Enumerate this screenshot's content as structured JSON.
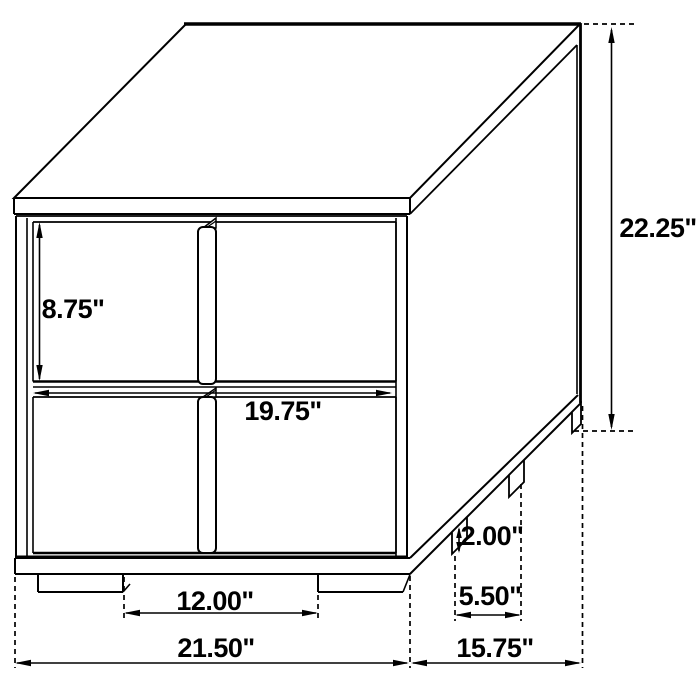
{
  "diagram": {
    "subject": "two-drawer-nightstand-dimension-drawing",
    "unit": "inches",
    "line_color": "#000000",
    "background_color": "#ffffff",
    "dimensions": [
      {
        "id": "top-drawer-height",
        "label": "8.75\""
      },
      {
        "id": "drawer-width",
        "label": "19.75\""
      },
      {
        "id": "overall-height",
        "label": "22.25\""
      },
      {
        "id": "foot-height",
        "label": "2.00\""
      },
      {
        "id": "side-foot-spacing",
        "label": "5.50\""
      },
      {
        "id": "front-foot-spacing",
        "label": "12.00\""
      },
      {
        "id": "overall-width",
        "label": "21.50\""
      },
      {
        "id": "overall-depth",
        "label": "15.75\""
      }
    ]
  }
}
